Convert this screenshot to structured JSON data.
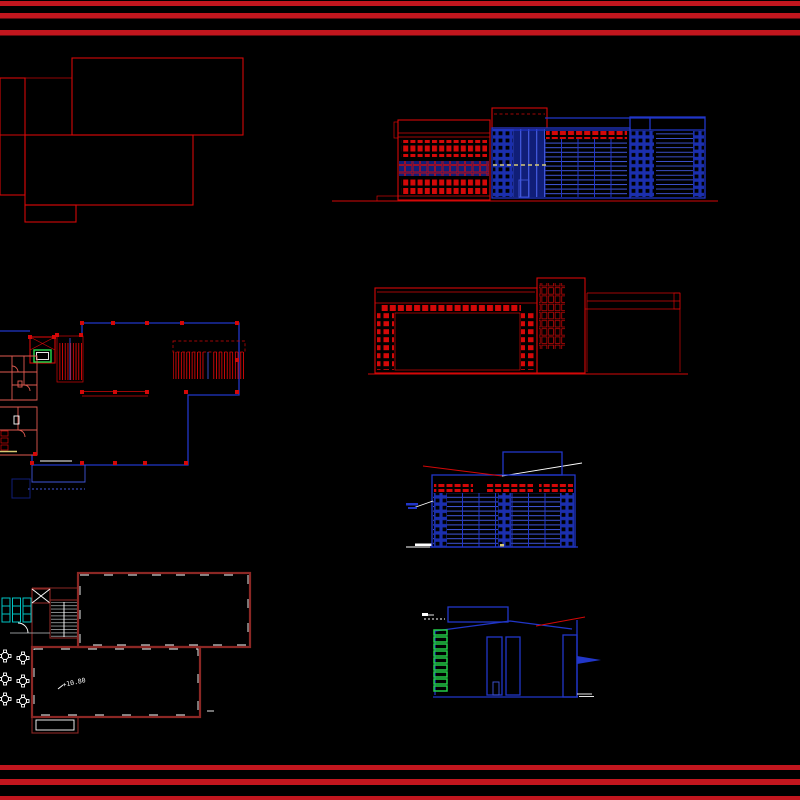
{
  "page": {
    "background": "#000000",
    "width": 800,
    "height": 800
  },
  "palette": {
    "background": "#000000",
    "border": "#c2161e",
    "red": "#d40808",
    "maroon": "#8b2724",
    "pink": "#e05a50",
    "blue": "#2136c8",
    "lightblue": "#4056d8",
    "bluedim": "#1b2fae",
    "bluedark": "#101e78",
    "cyan": "#00c4c4",
    "green": "#23cc47",
    "yellow": "#d8ca74",
    "white": "#ffffff",
    "gray": "#8f9396"
  },
  "border": {
    "top_line_count": 3,
    "bottom_line_count": 3
  },
  "annotations": {
    "floor_level": "+10.80"
  }
}
